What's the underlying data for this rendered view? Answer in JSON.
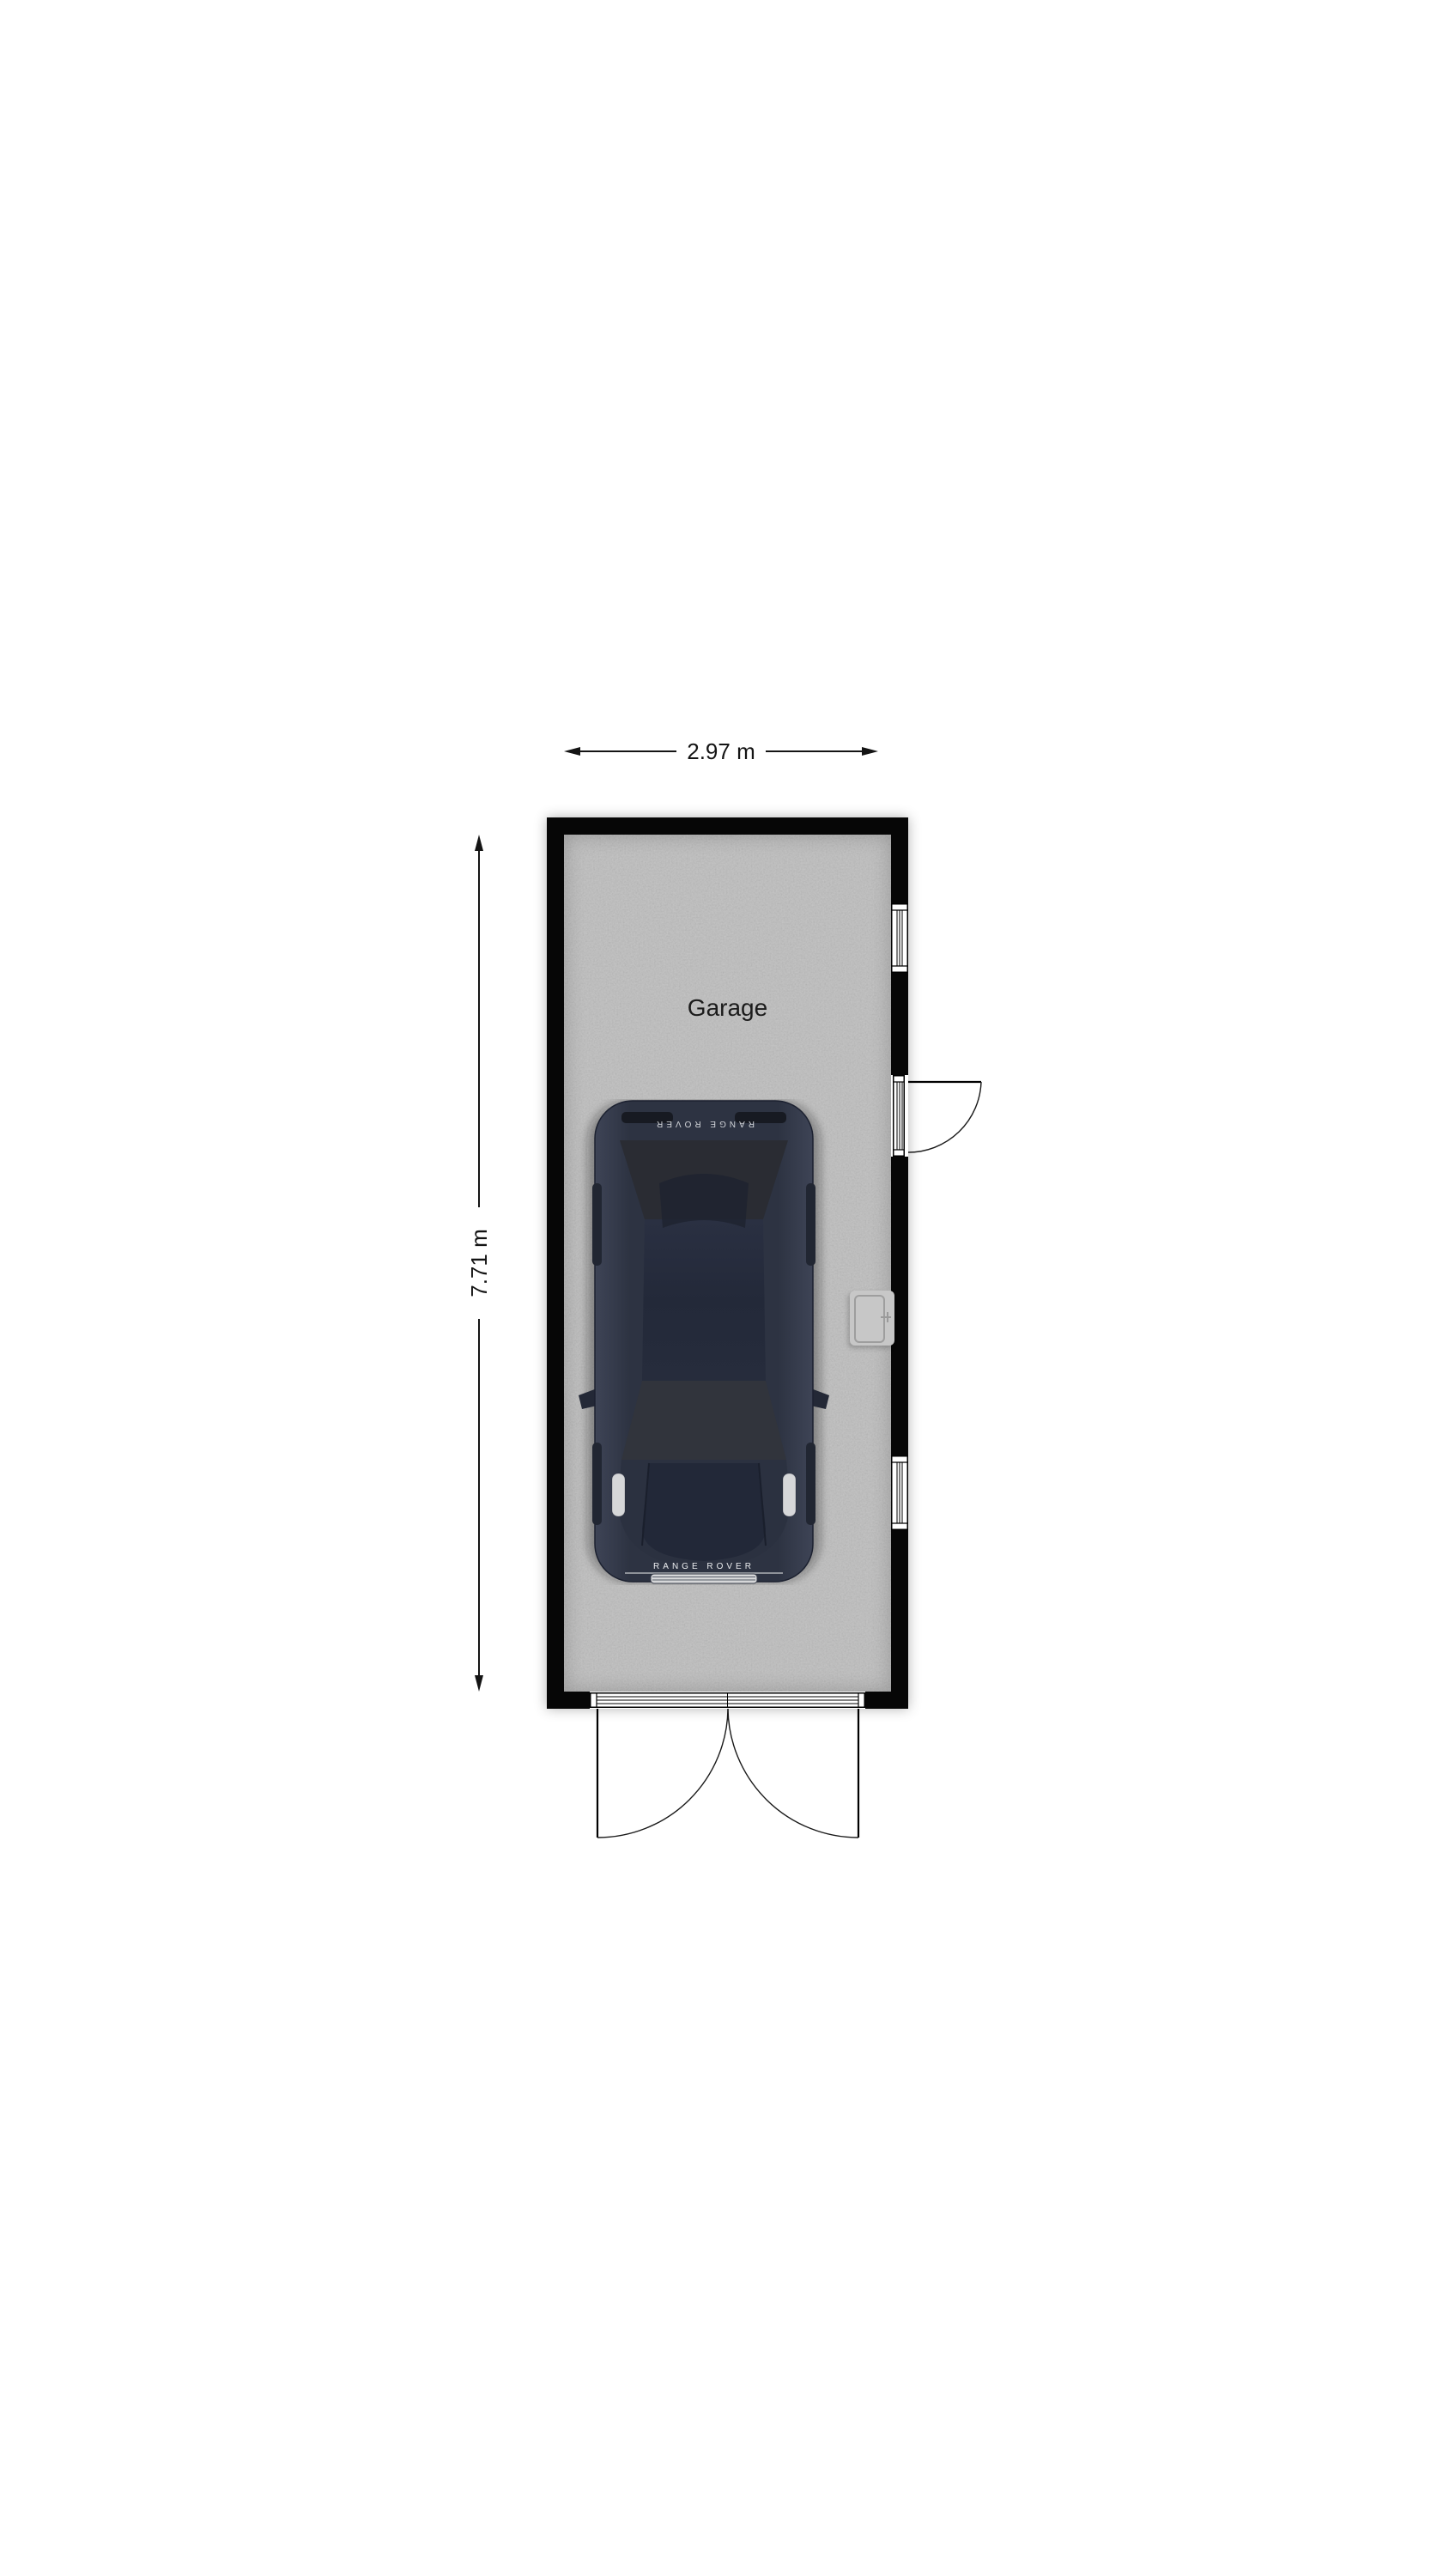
{
  "dimensions": {
    "width_label": "2.97 m",
    "height_label": "7.71 m"
  },
  "room": {
    "label": "Garage"
  },
  "car": {
    "badge": "RANGE ROVER"
  },
  "colors": {
    "wall": "#060606",
    "floor": "#bdbdbd",
    "dim": "#141414",
    "label": "#1b1b1b",
    "cabinet": "#c7c7c7",
    "cabinet-border": "#9e9e9e",
    "car-body": "#2d3342",
    "car-body-edge": "#3e4456",
    "car-glass": "#2a2c33",
    "car-roof": "#252b3b",
    "car-dark": "#1e2330",
    "silver": "#d6d7d9"
  }
}
